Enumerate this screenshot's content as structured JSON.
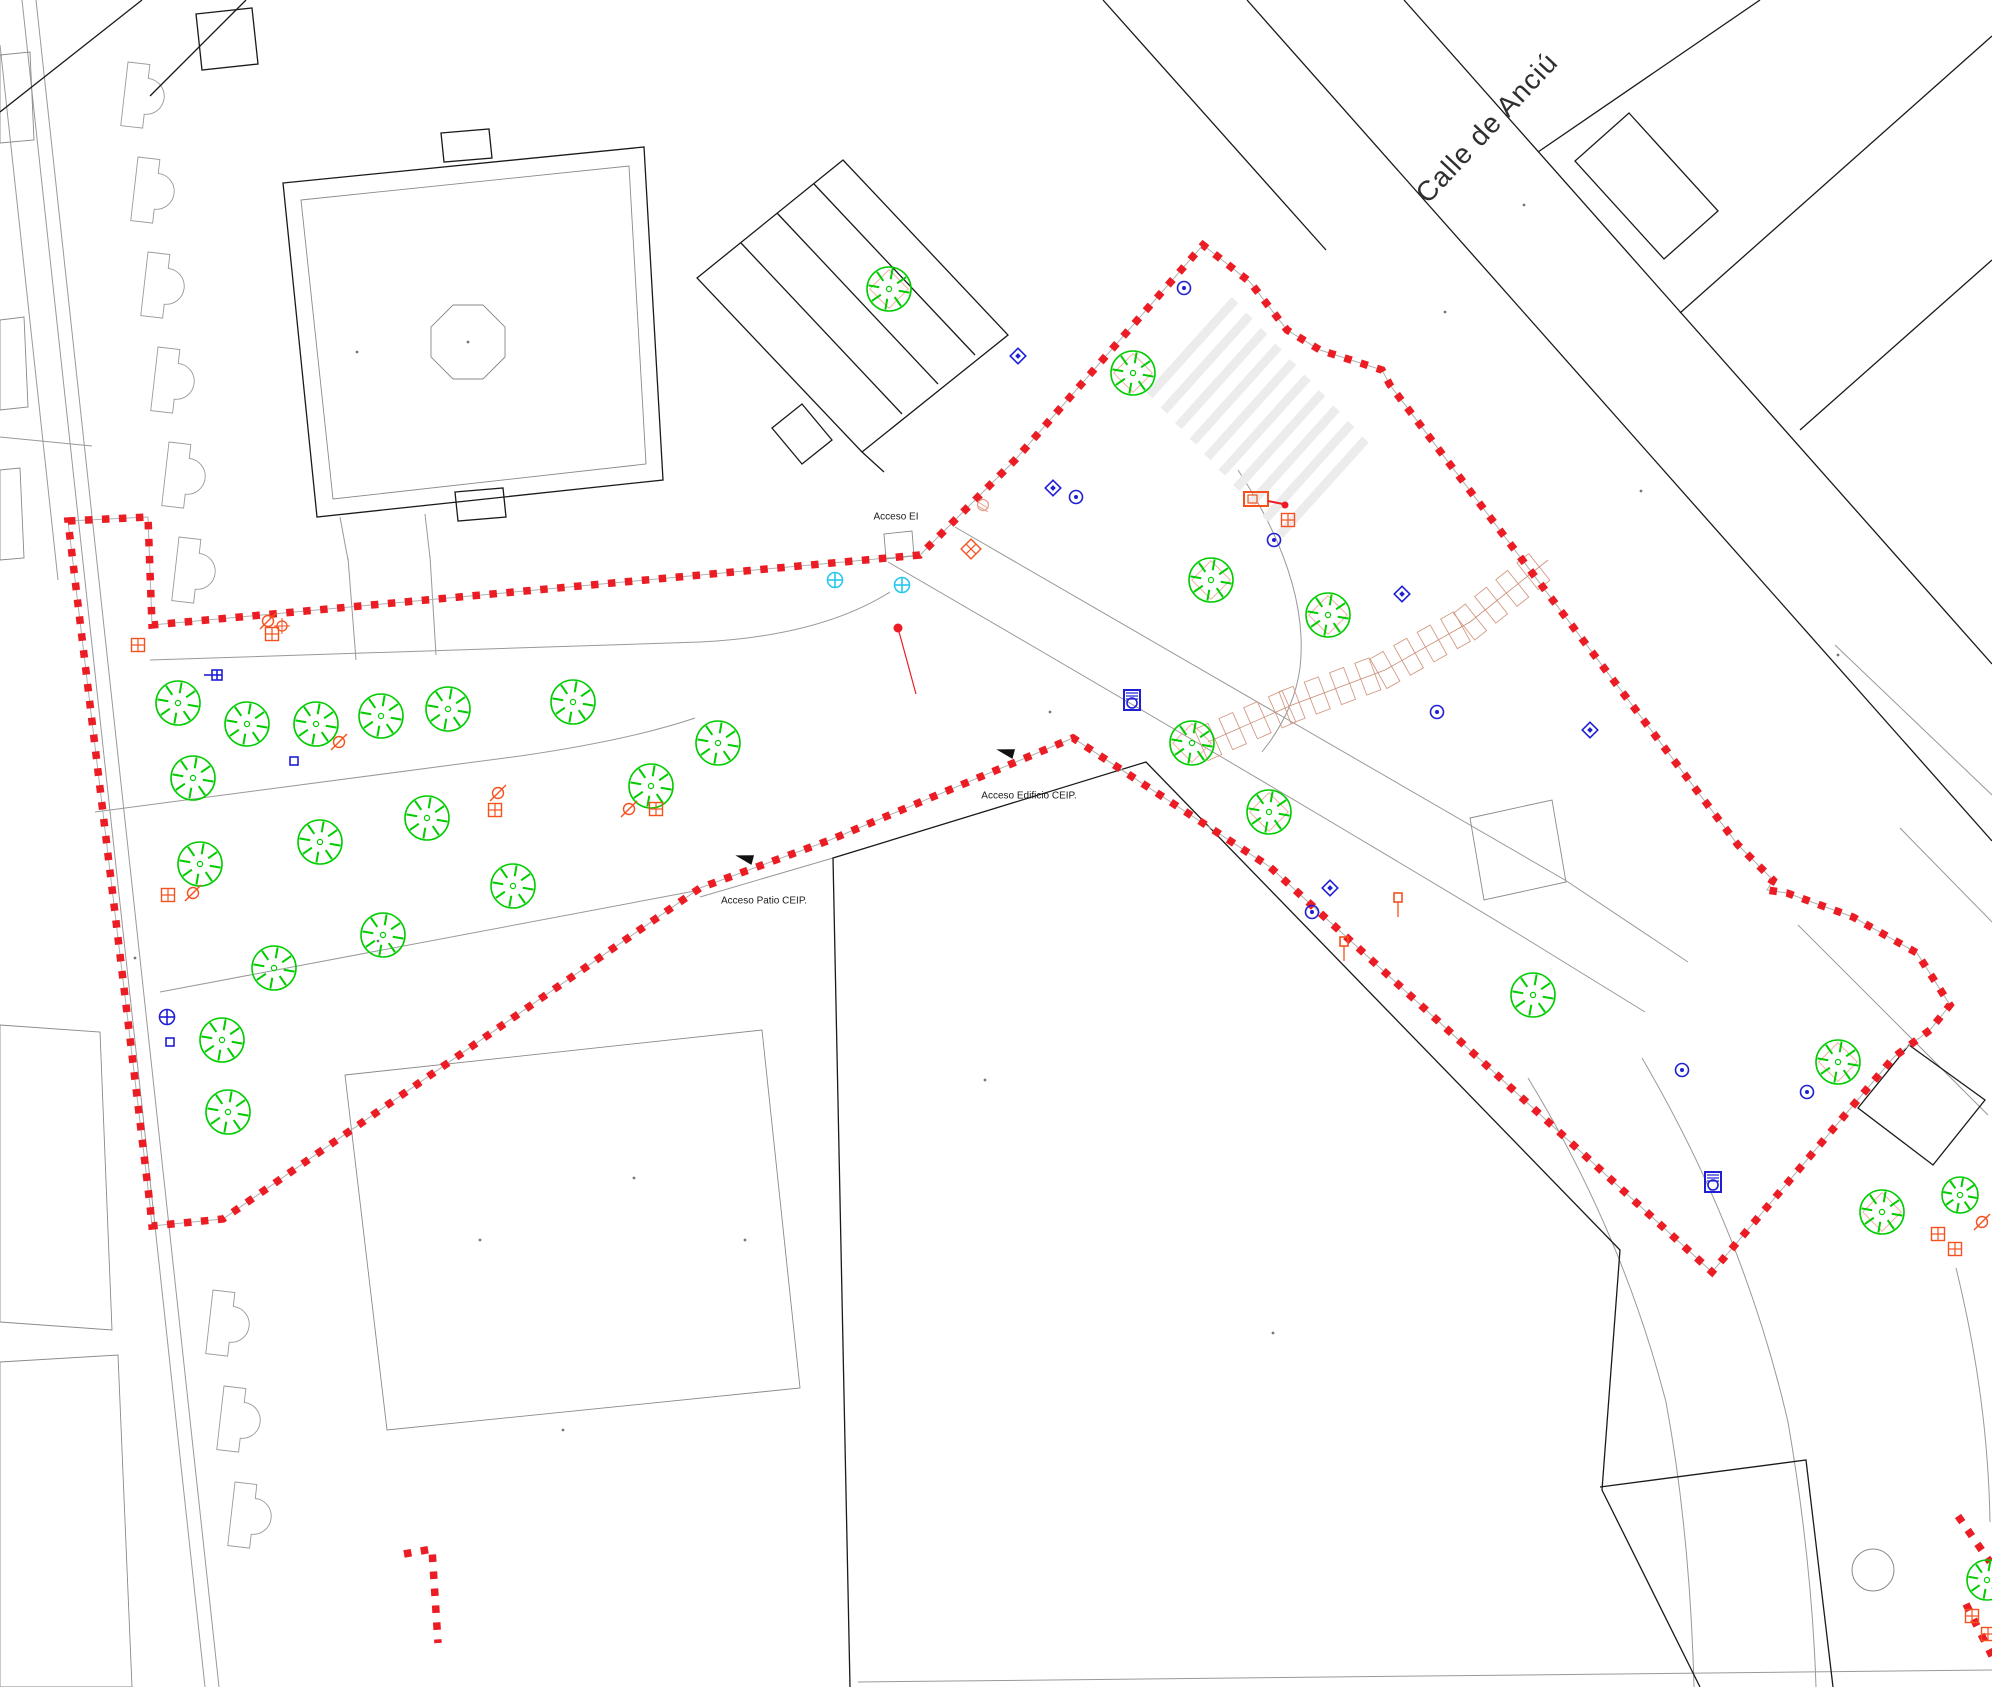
{
  "map": {
    "street_label": {
      "text": "Calle de Anciú",
      "x": 1487,
      "y": 128,
      "rotate": -47,
      "size": 28
    },
    "labels": [
      {
        "text": "Acceso EI",
        "x": 896,
        "y": 517,
        "size": 10
      },
      {
        "text": "Acceso Patio CEIP.",
        "x": 764,
        "y": 901,
        "size": 10
      },
      {
        "text": "Acceso Edificio CEIP.",
        "x": 1029,
        "y": 796,
        "size": 10
      }
    ],
    "colors": {
      "boundary": "#ec1c24",
      "tree": "#00cc00",
      "pit": "#edb29e",
      "parking": "#d49a84",
      "blue": "#1f1fd4",
      "cyan": "#27c7ee",
      "orange": "#f4511e",
      "red": "#ec1c24",
      "black_line": "#1a1a1a",
      "gray_line": "#999999",
      "crosswalk": "#ececec"
    },
    "boundary": {
      "main": "M68,521 L148,517 L152,625 L920,555 L1015,460 L1203,245 L1250,282 L1287,330 L1320,350 L1382,370 L1390,385 L1738,845 L1773,880 L1767,890 L1787,893 L1853,917 L1917,953 L1950,1005 L1930,1030 L1894,1057 L1712,1272 L1270,867 L1073,738 L830,840 L700,888 L223,1219 L152,1226 L150,1205 Z",
      "pieces": [
        "M404,1554 L432,1549 L438,1643",
        "M1958,1516 L1990,1562",
        "M1966,1604 L1992,1656"
      ],
      "dash": "7.5 9.5",
      "width": 7.5
    },
    "gray_lines": [
      "M22,0 L205,1687",
      "M36,0 L219,1687",
      "M0,45 L58,580",
      "M0,437 L92,446",
      "M150,660 L700,642 Q820,636 890,592",
      "M95,812 L520,756 Q630,740 695,718",
      "M160,992 L700,890",
      "M888,562 Q1250,772 1520,935 L1645,1012",
      "M955,527 Q1290,722 1565,880 L1688,962",
      "M1238,470 Q1310,580 1300,668 Q1294,712 1262,752",
      "M1528,1078 Q1622,1232 1666,1402 Q1690,1532 1694,1687",
      "M1642,1058 Q1744,1232 1788,1422 Q1812,1562 1816,1687",
      "M1956,1268 Q1988,1398 1990,1522",
      "M858,1682 L1992,1670",
      "M1798,925 L1988,1115",
      "M1900,828 L1992,922",
      "M1835,645 L1992,795",
      "M833,858 L700,897",
      "M348,558 L356,660",
      "M430,556 L436,655",
      "M340,517 L348,560",
      "M425,514 L430,558"
    ],
    "gray_polys": [
      [
        [
          0,
          55
        ],
        [
          30,
          52
        ],
        [
          34,
          140
        ],
        [
          0,
          143
        ]
      ],
      [
        [
          0,
          320
        ],
        [
          24,
          317
        ],
        [
          28,
          407
        ],
        [
          0,
          410
        ]
      ],
      [
        [
          0,
          470
        ],
        [
          20,
          468
        ],
        [
          24,
          558
        ],
        [
          0,
          560
        ]
      ],
      [
        [
          0,
          1025
        ],
        [
          100,
          1032
        ],
        [
          112,
          1330
        ],
        [
          0,
          1322
        ]
      ],
      [
        [
          0,
          1362
        ],
        [
          118,
          1355
        ],
        [
          132,
          1687
        ],
        [
          0,
          1687
        ]
      ],
      [
        [
          345,
          1075
        ],
        [
          762,
          1030
        ],
        [
          800,
          1388
        ],
        [
          387,
          1430
        ]
      ],
      [
        [
          301,
          200
        ],
        [
          629,
          166
        ],
        [
          646,
          464
        ],
        [
          333,
          499
        ]
      ],
      [
        [
          505,
          357
        ],
        [
          483,
          379
        ],
        [
          453,
          379
        ],
        [
          431,
          357
        ],
        [
          431,
          327
        ],
        [
          453,
          305
        ],
        [
          483,
          305
        ],
        [
          505,
          327
        ]
      ],
      [
        [
          884,
          534
        ],
        [
          912,
          531
        ],
        [
          914,
          556
        ],
        [
          886,
          559
        ]
      ],
      [
        [
          1470,
          818
        ],
        [
          1552,
          800
        ],
        [
          1566,
          882
        ],
        [
          1484,
          900
        ]
      ]
    ],
    "black_lines": [
      "M850,1687 L833,858 L1146,762 L1620,1250 L1602,1490 L1700,1687",
      "M1600,1487 L1806,1460 L1833,1687",
      "M1103,0 L1326,250",
      "M1247,0 L1992,841",
      "M1404,0 L1992,664",
      "M1538,152 L1760,0",
      "M1680,313 L1992,36",
      "M1800,430 L1992,260",
      "M0,112 L142,0",
      "M150,96 L246,0",
      "M741,243 L902,414",
      "M777,213 L938,384",
      "M814,184 L975,355",
      "M862,452 L884,472"
    ],
    "black_polys": [
      [
        [
          283,
          183
        ],
        [
          644,
          147
        ],
        [
          663,
          480
        ],
        [
          317,
          517
        ]
      ],
      [
        [
          441,
          133
        ],
        [
          489,
          129
        ],
        [
          492,
          158
        ],
        [
          444,
          162
        ]
      ],
      [
        [
          455,
          492
        ],
        [
          503,
          488
        ],
        [
          506,
          517
        ],
        [
          458,
          521
        ]
      ],
      [
        [
          697,
          278
        ],
        [
          843,
          160
        ],
        [
          1008,
          335
        ],
        [
          862,
          452
        ]
      ],
      [
        [
          772,
          428
        ],
        [
          802,
          404
        ],
        [
          832,
          440
        ],
        [
          802,
          464
        ]
      ],
      [
        [
          1629,
          113
        ],
        [
          1718,
          211
        ],
        [
          1664,
          259
        ],
        [
          1575,
          161
        ]
      ],
      [
        [
          196,
          14
        ],
        [
          252,
          8
        ],
        [
          258,
          64
        ],
        [
          202,
          70
        ]
      ],
      [
        [
          1909,
          1045
        ],
        [
          1985,
          1100
        ],
        [
          1933,
          1165
        ],
        [
          1858,
          1108
        ]
      ]
    ],
    "bays": [
      [
        128,
        62
      ],
      [
        138,
        157
      ],
      [
        148,
        252
      ],
      [
        158,
        347
      ],
      [
        169,
        442
      ],
      [
        179,
        537
      ],
      [
        213,
        1290
      ],
      [
        224,
        1386
      ],
      [
        235,
        1482
      ]
    ],
    "bay_angle": 6.5,
    "crosswalk": {
      "x": 1235,
      "y": 300,
      "dx": 14.5,
      "dy": 15.5,
      "count": 10,
      "len": 128,
      "w": 9,
      "angle": 132
    },
    "parking": {
      "axis": [
        [
          1208,
          742
        ],
        [
          1292,
          705
        ],
        [
          1385,
          670
        ],
        [
          1470,
          622
        ],
        [
          1548,
          560
        ]
      ],
      "spacing": 27,
      "stall_w": 15,
      "stall_l": 34
    },
    "trees": [
      {
        "x": 178,
        "y": 703
      },
      {
        "x": 247,
        "y": 724
      },
      {
        "x": 316,
        "y": 724
      },
      {
        "x": 381,
        "y": 716
      },
      {
        "x": 448,
        "y": 709
      },
      {
        "x": 573,
        "y": 702
      },
      {
        "x": 193,
        "y": 778
      },
      {
        "x": 427,
        "y": 818
      },
      {
        "x": 320,
        "y": 842
      },
      {
        "x": 200,
        "y": 864
      },
      {
        "x": 513,
        "y": 886
      },
      {
        "x": 383,
        "y": 935
      },
      {
        "x": 274,
        "y": 968
      },
      {
        "x": 222,
        "y": 1040
      },
      {
        "x": 228,
        "y": 1112
      },
      {
        "x": 651,
        "y": 786
      },
      {
        "x": 718,
        "y": 743
      },
      {
        "x": 889,
        "y": 289,
        "pit": true
      },
      {
        "x": 1133,
        "y": 373,
        "pit": true
      },
      {
        "x": 1211,
        "y": 580,
        "pit": true
      },
      {
        "x": 1328,
        "y": 615,
        "pit": true
      },
      {
        "x": 1192,
        "y": 743,
        "pit": true
      },
      {
        "x": 1269,
        "y": 812,
        "pit": true
      },
      {
        "x": 1533,
        "y": 995
      },
      {
        "x": 1838,
        "y": 1062,
        "pit": true
      },
      {
        "x": 1882,
        "y": 1212,
        "pit": true
      },
      {
        "x": 1960,
        "y": 1195,
        "r": 18
      },
      {
        "x": 1987,
        "y": 1580,
        "r": 20
      }
    ],
    "tree_r": 22,
    "symbols": [
      {
        "t": "circle-plus",
        "x": 835,
        "y": 580,
        "c": "#27c7ee"
      },
      {
        "t": "circle-plus",
        "x": 902,
        "y": 585,
        "c": "#27c7ee"
      },
      {
        "t": "circle-plus",
        "x": 167,
        "y": 1017,
        "c": "#1f1fd4"
      },
      {
        "t": "target",
        "x": 1076,
        "y": 497,
        "c": "#1f1fd4"
      },
      {
        "t": "target",
        "x": 1184,
        "y": 288,
        "c": "#1f1fd4"
      },
      {
        "t": "target",
        "x": 1274,
        "y": 540,
        "c": "#1f1fd4"
      },
      {
        "t": "target",
        "x": 1437,
        "y": 712,
        "c": "#1f1fd4"
      },
      {
        "t": "target",
        "x": 1807,
        "y": 1092,
        "c": "#1f1fd4"
      },
      {
        "t": "target",
        "x": 1682,
        "y": 1070,
        "c": "#1f1fd4"
      },
      {
        "t": "target",
        "x": 1312,
        "y": 912,
        "c": "#1f1fd4"
      },
      {
        "t": "diamond-dot",
        "x": 1053,
        "y": 488,
        "c": "#1f1fd4"
      },
      {
        "t": "diamond-dot",
        "x": 1402,
        "y": 594,
        "c": "#1f1fd4"
      },
      {
        "t": "diamond-dot",
        "x": 1590,
        "y": 730,
        "c": "#1f1fd4"
      },
      {
        "t": "diamond-dot",
        "x": 1330,
        "y": 888,
        "c": "#1f1fd4"
      },
      {
        "t": "diamond-dot",
        "x": 1018,
        "y": 356,
        "c": "#1f1fd4"
      },
      {
        "t": "square-plus",
        "x": 217,
        "y": 675,
        "c": "#1f1fd4"
      },
      {
        "t": "small-square",
        "x": 294,
        "y": 761,
        "c": "#1f1fd4"
      },
      {
        "t": "small-square",
        "x": 170,
        "y": 1042,
        "c": "#1f1fd4"
      },
      {
        "t": "bench",
        "x": 1132,
        "y": 700,
        "c": "#1f1fd4"
      },
      {
        "t": "bench",
        "x": 1713,
        "y": 1182,
        "c": "#1f1fd4"
      },
      {
        "t": "grid-square",
        "x": 138,
        "y": 645,
        "c": "#f4511e"
      },
      {
        "t": "grid-square",
        "x": 272,
        "y": 634,
        "c": "#f4511e"
      },
      {
        "t": "grid-square",
        "x": 168,
        "y": 895,
        "c": "#f4511e"
      },
      {
        "t": "grid-square",
        "x": 495,
        "y": 810,
        "c": "#f4511e"
      },
      {
        "t": "grid-square",
        "x": 656,
        "y": 809,
        "c": "#f4511e"
      },
      {
        "t": "grid-square",
        "x": 1288,
        "y": 520,
        "c": "#f4511e"
      },
      {
        "t": "grid-square",
        "x": 1938,
        "y": 1234,
        "c": "#f4511e"
      },
      {
        "t": "grid-square",
        "x": 1955,
        "y": 1249,
        "c": "#f4511e"
      },
      {
        "t": "grid-square",
        "x": 1972,
        "y": 1616,
        "c": "#f4511e"
      },
      {
        "t": "grid-square",
        "x": 1988,
        "y": 1634,
        "c": "#f4511e"
      },
      {
        "t": "grid-diamond",
        "x": 971,
        "y": 549,
        "c": "#f4511e"
      },
      {
        "t": "slash-circle",
        "x": 193,
        "y": 893,
        "c": "#f4511e"
      },
      {
        "t": "slash-circle",
        "x": 268,
        "y": 621,
        "c": "#f4511e"
      },
      {
        "t": "slash-circle",
        "x": 498,
        "y": 793,
        "c": "#f4511e"
      },
      {
        "t": "slash-circle",
        "x": 629,
        "y": 809,
        "c": "#f4511e"
      },
      {
        "t": "slash-circle",
        "x": 339,
        "y": 742,
        "c": "#f4511e"
      },
      {
        "t": "slash-circle",
        "x": 1982,
        "y": 1222,
        "c": "#f4511e"
      },
      {
        "t": "target-cross",
        "x": 282,
        "y": 626,
        "c": "#f4511e"
      },
      {
        "t": "hatch-circle",
        "x": 983,
        "y": 505,
        "c": "#e8a18d"
      },
      {
        "t": "sign",
        "x": 1258,
        "y": 500,
        "c": "#f4511e"
      },
      {
        "t": "pole",
        "x": 1344,
        "y": 950,
        "c": "#f4511e"
      },
      {
        "t": "pole",
        "x": 1398,
        "y": 906,
        "c": "#f4511e"
      },
      {
        "t": "reddot",
        "x": 898,
        "y": 628,
        "c": "#ec1c24"
      }
    ],
    "arrows": [
      {
        "x": 745,
        "y": 858,
        "a": 195
      },
      {
        "x": 1006,
        "y": 752,
        "a": 195
      }
    ],
    "dots": [
      [
        357,
        352
      ],
      [
        1445,
        312
      ],
      [
        1050,
        712
      ],
      [
        634,
        1178
      ],
      [
        378,
        941
      ],
      [
        745,
        1240
      ],
      [
        1273,
        1333
      ],
      [
        563,
        1430
      ],
      [
        135,
        958
      ],
      [
        1524,
        205
      ],
      [
        1641,
        491
      ],
      [
        468,
        342
      ],
      [
        1838,
        655
      ],
      [
        985,
        1080
      ],
      [
        480,
        1240
      ]
    ],
    "circle": {
      "x": 1873,
      "y": 1570,
      "r": 21
    }
  }
}
